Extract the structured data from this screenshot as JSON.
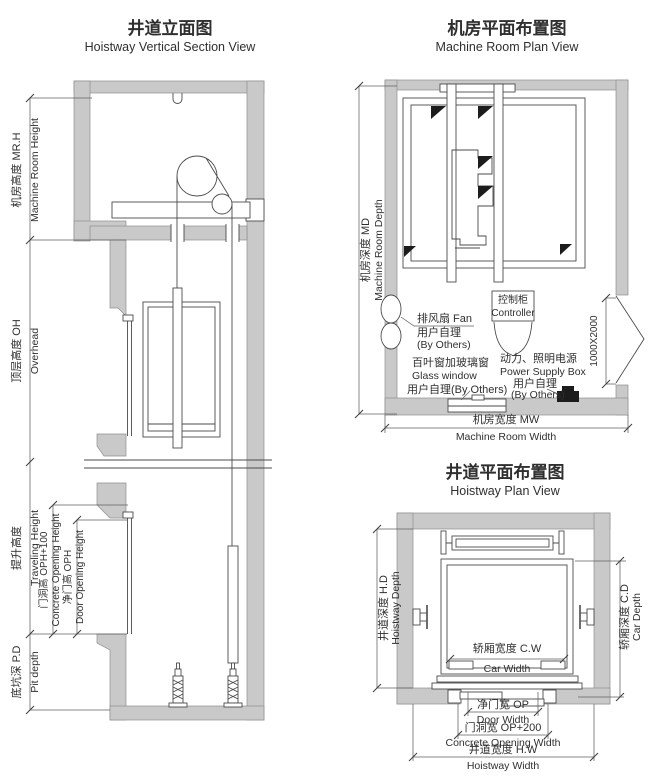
{
  "section_view": {
    "title_zh": "井道立面图",
    "title_en": "Hoistway Vertical Section View",
    "dims": {
      "machine_room_height_zh": "机房高度 MR.H",
      "machine_room_height_en": "Machine Room Height",
      "overhead_zh": "顶层高度 OH",
      "overhead_en": "Overhead",
      "traveling_height_zh": "提升高度",
      "traveling_height_en": "Traveling Height",
      "concrete_opening_height_zh": "门洞高 OPH+100",
      "concrete_opening_height_en": "Concrete Opening Height",
      "door_opening_height_zh": "净门高 OPH",
      "door_opening_height_en": "Door Opening Height",
      "pit_depth_zh": "底坑深 P.D",
      "pit_depth_en": "Pit depth"
    }
  },
  "machine_room_plan": {
    "title_zh": "机房平面布置图",
    "title_en": "Machine Room Plan View",
    "labels": {
      "fan_zh": "排风扇 Fan",
      "fan_note_zh": "用户自理",
      "fan_note_en": "(By Others)",
      "glass_window_zh": "百叶窗加玻璃窗",
      "glass_window_en": "Glass window",
      "glass_note": "用户自理(By Others)",
      "controller_zh": "控制柜",
      "controller_en": "Controller",
      "power_zh": "动力、照明电源",
      "power_en": "Power Supply Box",
      "power_note_zh": "用户自理",
      "power_note_en": "(By Others)",
      "door_size": "1000X2000"
    },
    "dims": {
      "depth_zh": "机房深度 MD",
      "depth_en": "Machine Room Depth",
      "width_zh": "机房宽度 MW",
      "width_en": "Machine Room Width"
    }
  },
  "hoistway_plan": {
    "title_zh": "井道平面布置图",
    "title_en": "Hoistway Plan View",
    "dims": {
      "hoistway_depth_zh": "井道深度 H.D",
      "hoistway_depth_en": "Hoistway Depth",
      "car_depth_zh": "轿厢深度 C.D",
      "car_depth_en": "Car Depth",
      "car_width_zh": "轿厢宽度 C.W",
      "car_width_en": "Car Width",
      "door_width_zh": "净门宽 OP",
      "door_width_en": "Door Width",
      "concrete_opening_width_zh": "门洞宽 OP+200",
      "concrete_opening_width_en": "Concrete Opening Width",
      "hoistway_width_zh": "井道宽度 H.W",
      "hoistway_width_en": "Hoistway Width"
    }
  },
  "colors": {
    "wall": "#c9c9c9",
    "line": "#4b4b4b",
    "text": "#2f2f2f"
  }
}
